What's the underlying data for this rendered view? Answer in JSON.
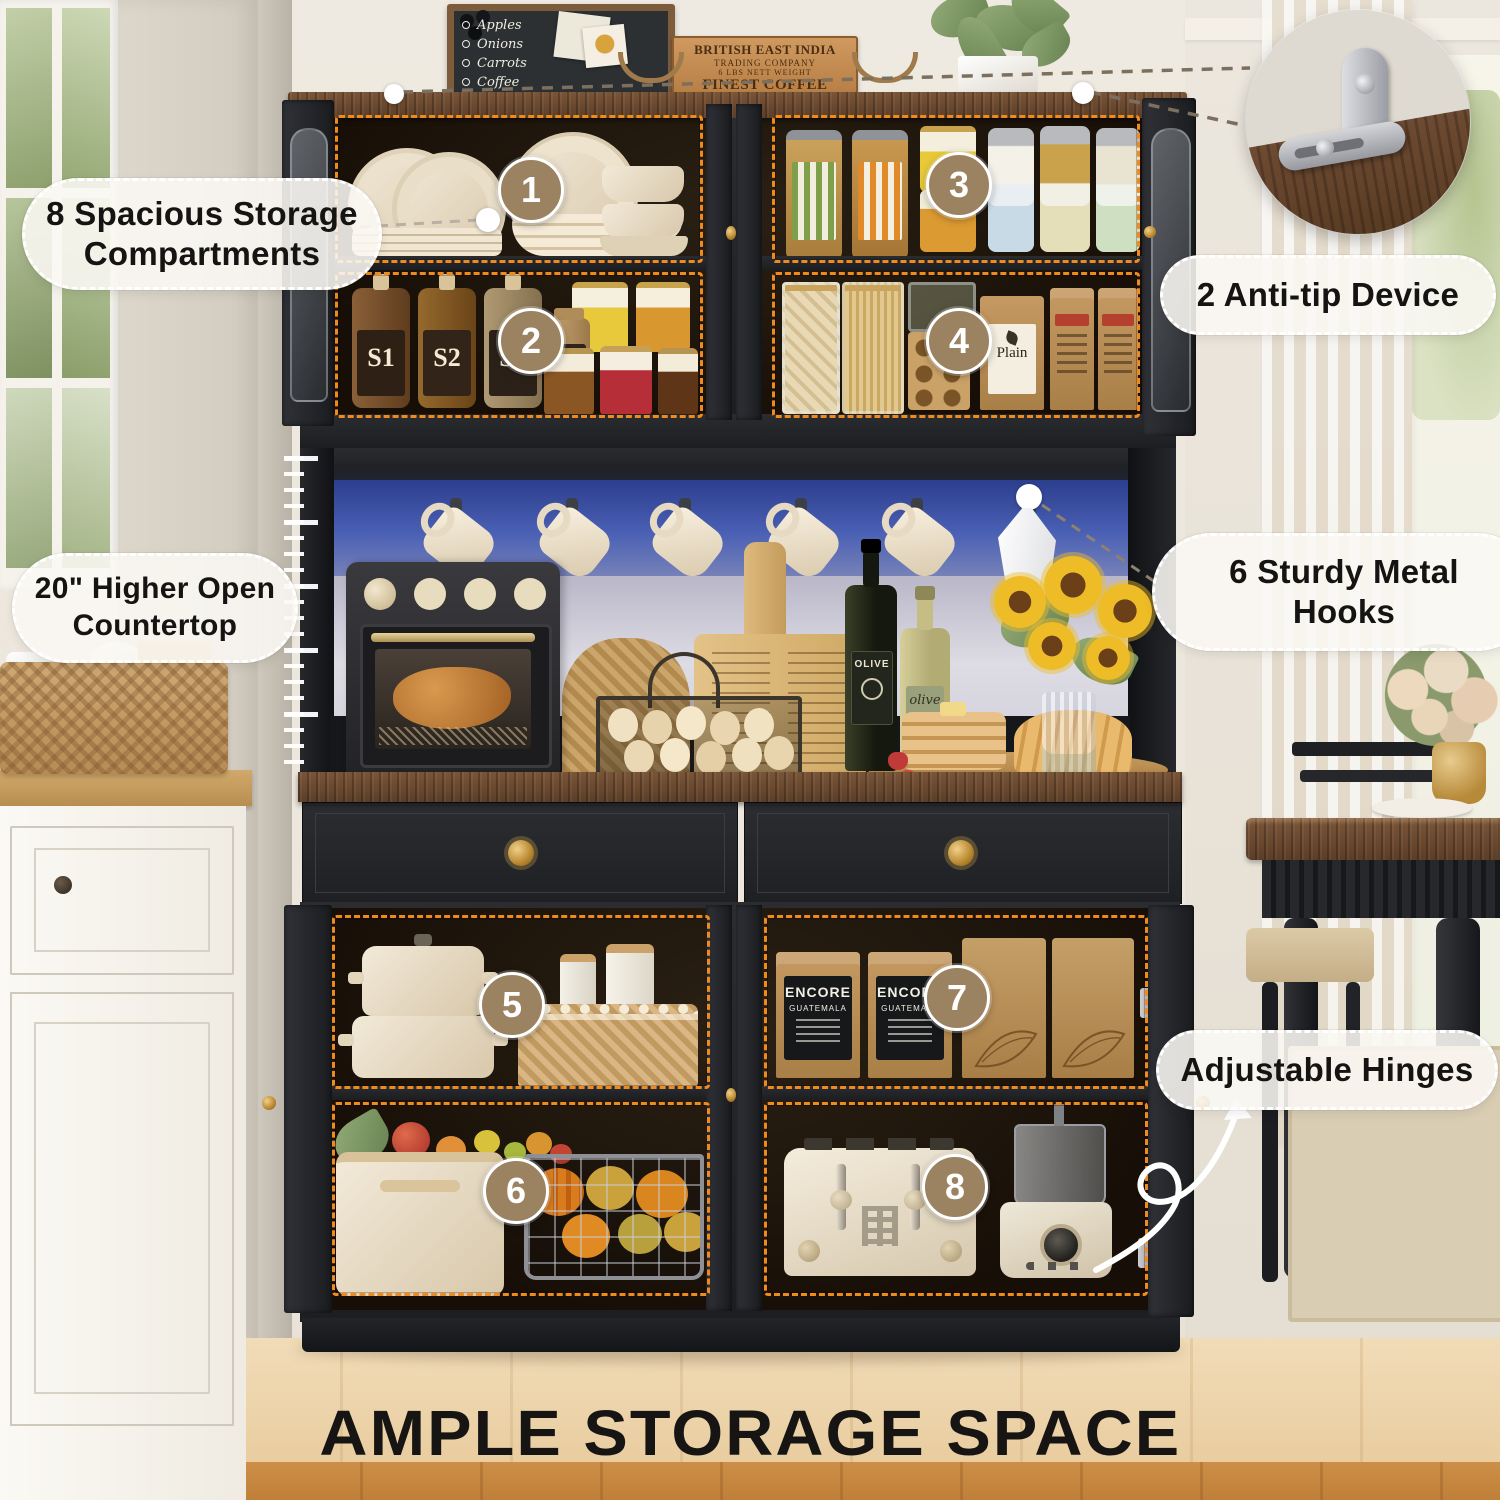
{
  "heading": "AMPLE STORAGE SPACE",
  "callouts": {
    "compartments": "8 Spacious Storage Compartments",
    "antitip": "2 Anti-tip Device",
    "countertop": "20\" Higher Open Countertop",
    "hooks": "6 Sturdy Metal Hooks",
    "hinges": "Adjustable Hinges"
  },
  "markers": [
    "1",
    "2",
    "3",
    "4",
    "5",
    "6",
    "7",
    "8"
  ],
  "decor": {
    "blackboard_items": [
      "Apples",
      "Onions",
      "Carrots",
      "Coffee"
    ],
    "crate_lines": [
      "BRITISH EAST INDIA",
      "TRADING COMPANY",
      "6 LBS NETT WEIGHT",
      "FINEST COFFEE"
    ]
  },
  "products": {
    "syrup_labels": [
      "S1",
      "S2",
      "S3",
      "CI"
    ],
    "coffee_bag_brand": "ENCORE",
    "coffee_bag_origin": "GUATEMALA",
    "flour_bag_label": "Plain",
    "oil_bottle_dark": "OLIVE",
    "oil_bottle_light": "olive"
  },
  "colors": {
    "compartment_outline": "#ef8a1e",
    "marker_fill": "#9b8260",
    "led_strip": "#3d55a8",
    "cabinet_black": "#232528",
    "wood_top": "#6a4a33",
    "floor": "#eed5ad"
  }
}
